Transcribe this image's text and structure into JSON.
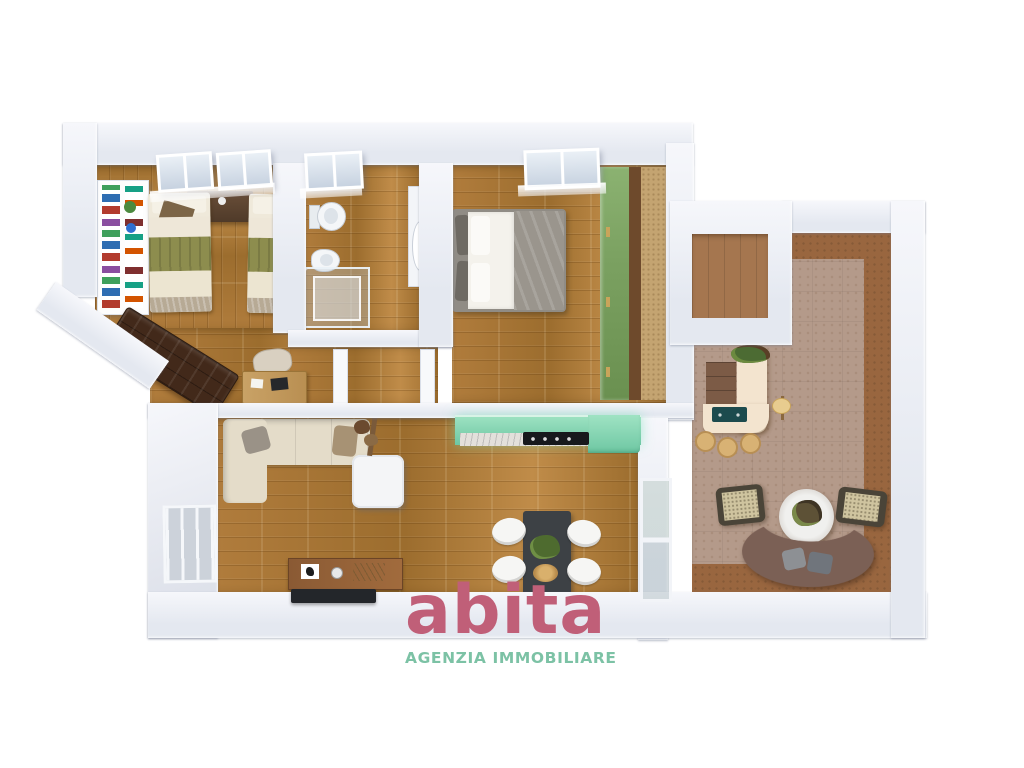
{
  "brand": {
    "name": "abita",
    "tagline": "AGENZIA IMMOBILIARE"
  },
  "palette": {
    "wall": "#e4e8f0",
    "wall-light": "#f6f7fb",
    "wall-deep": "#d8dce6",
    "wood-a": "#b07c3c",
    "wood-b": "#9c6d2e",
    "wood-c": "#c08c49",
    "terrace": "#b49a8a",
    "terrace-border": "#99663f",
    "alcove-floor": "#a5764f",
    "kitchen-a": "#9fe3c3",
    "kitchen-b": "#6ec7a3",
    "grill": "#1c4b4e",
    "brand-pink": "#c05f78",
    "brand-teal": "#7cc2a5",
    "olive": "#8d8d4e",
    "bed-cream": "#ece5d1",
    "bed-tail": "#b7aa95",
    "sofa-brown": "#42291a",
    "sofa-beige": "#e4dcc9",
    "curved-sofa": "#7b6055",
    "bed-frame": "#908c85",
    "blanket": "#9a958d",
    "wardrobe-green": "#7ba161",
    "rug-tan": "#c4a471",
    "bar-cream": "#f3e4cf",
    "stool-tan": "#d8b274",
    "table-dark": "#3d4145"
  }
}
